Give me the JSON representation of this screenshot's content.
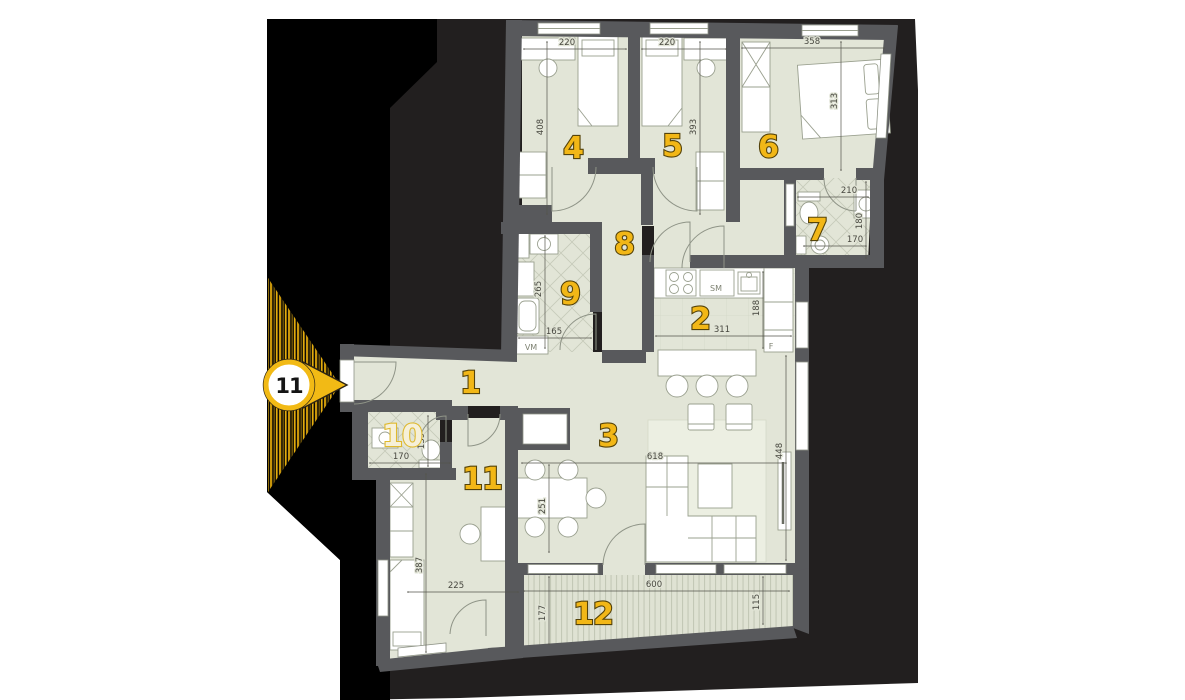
{
  "scene": {
    "marker": {
      "label": "11"
    },
    "palette": {
      "page": "#ffffff",
      "silhouette": "#221f1f",
      "shadow": "#000000",
      "wall": "#58595c",
      "floor": "#e2e5d7",
      "accent_yellow": "#f2b717",
      "dim_text": "#47473f"
    }
  },
  "rooms": {
    "r1": {
      "number": "1"
    },
    "r2": {
      "number": "2"
    },
    "r3": {
      "number": "3"
    },
    "r4": {
      "number": "4"
    },
    "r5": {
      "number": "5"
    },
    "r6": {
      "number": "6"
    },
    "r7": {
      "number": "7"
    },
    "r8": {
      "number": "8"
    },
    "r9": {
      "number": "9"
    },
    "r10": {
      "number": "10"
    },
    "r11": {
      "number": "11"
    },
    "r12": {
      "number": "12"
    }
  },
  "dims": {
    "room4_width": "220",
    "room4_depth": "408",
    "room5_width": "220",
    "room5_depth": "393",
    "room6_width": "358",
    "room6_depth": "313",
    "room7_width": "210",
    "room7_depth": "180",
    "room7_fixture": "170",
    "room9_depth": "265",
    "room9_width": "165",
    "room10_width": "170",
    "room10_depth": "139",
    "kitchen_width": "311",
    "kitchen_depth": "188",
    "dining_width": "251",
    "living_width": "618",
    "living_depth": "448",
    "room11_depth": "387",
    "room11_width": "225",
    "terrace_width": "600",
    "terrace_left_depth": "177",
    "terrace_right_depth": "115"
  },
  "appliances": {
    "washing_machine": "VM",
    "dishwasher": "SM",
    "fridge": "F"
  }
}
